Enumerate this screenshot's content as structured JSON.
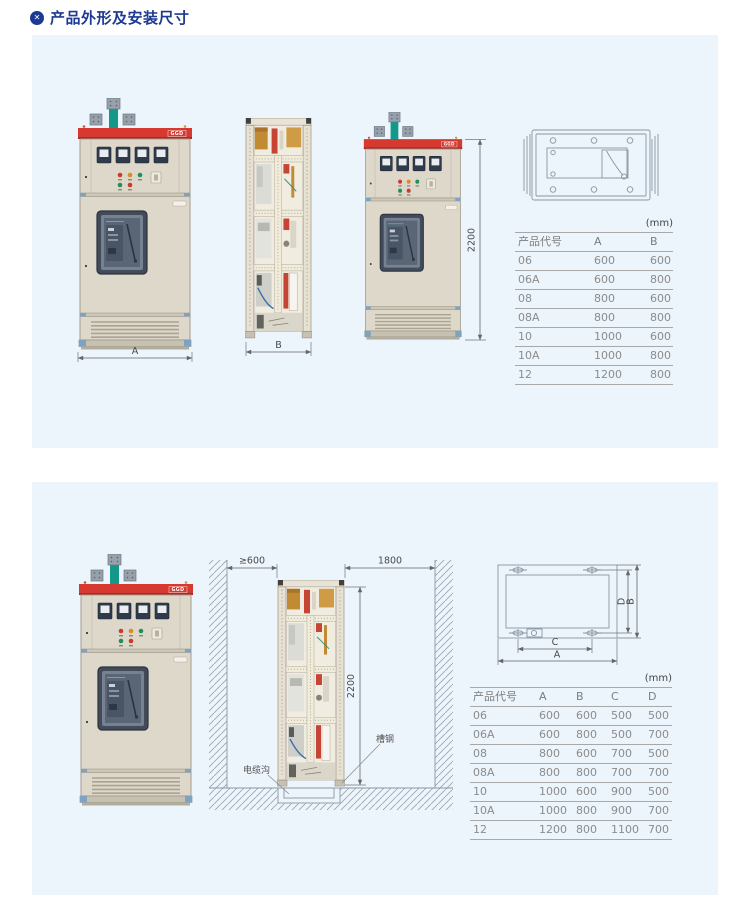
{
  "page": {
    "title": "产品外形及安装尺寸"
  },
  "brand": {
    "logo": "GGD"
  },
  "top_section": {
    "front_view_width_label": "A",
    "side_view_width_label": "B",
    "height_dim_label": "2200",
    "table": {
      "unit_label": "(mm)",
      "headers": [
        "产品代号",
        "A",
        "B"
      ],
      "rows": [
        [
          "06",
          "600",
          "600"
        ],
        [
          "06A",
          "600",
          "800"
        ],
        [
          "08",
          "800",
          "600"
        ],
        [
          "08A",
          "800",
          "800"
        ],
        [
          "10",
          "1000",
          "600"
        ],
        [
          "10A",
          "1000",
          "800"
        ],
        [
          "12",
          "1200",
          "800"
        ]
      ]
    }
  },
  "bottom_section": {
    "left_clearance_label": "≥600",
    "right_clearance_label": "1800",
    "height_dim_label": "2200",
    "cable_trench_label": "电缆沟",
    "channel_steel_label": "槽钢",
    "footprint": {
      "dim_a": "A",
      "dim_b": "B",
      "dim_c": "C",
      "dim_d": "D"
    },
    "table": {
      "unit_label": "(mm)",
      "headers": [
        "产品代号",
        "A",
        "B",
        "C",
        "D"
      ],
      "rows": [
        [
          "06",
          "600",
          "600",
          "500",
          "500"
        ],
        [
          "06A",
          "600",
          "800",
          "500",
          "700"
        ],
        [
          "08",
          "800",
          "600",
          "700",
          "500"
        ],
        [
          "08A",
          "800",
          "800",
          "700",
          "700"
        ],
        [
          "10",
          "1000",
          "600",
          "900",
          "500"
        ],
        [
          "10A",
          "1000",
          "800",
          "900",
          "700"
        ],
        [
          "12",
          "1200",
          "800",
          "1100",
          "700"
        ]
      ]
    }
  }
}
